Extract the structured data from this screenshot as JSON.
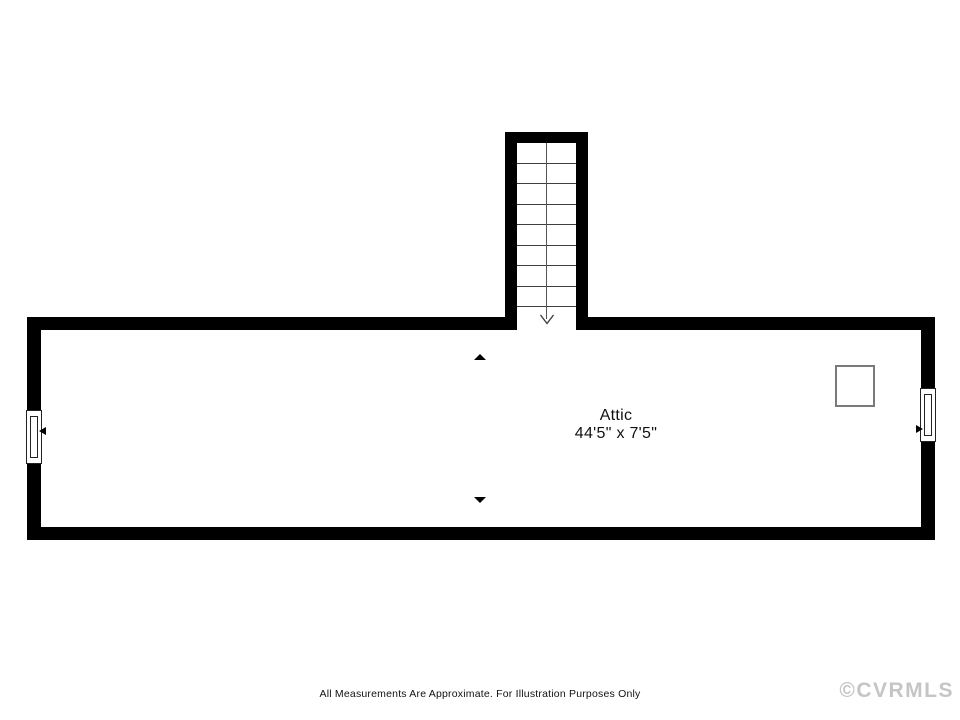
{
  "floor_plan": {
    "room": {
      "name": "Attic",
      "dimensions": "44'5\" x 7'5\""
    },
    "stairs": {
      "tread_count": 9,
      "direction": "down",
      "arrow_icon": "open-v-down-arrow"
    },
    "features": {
      "chimney": "square-outline",
      "left_window": "double-hung-window",
      "right_window": "double-hung-window",
      "section_markers": [
        "triangle-up",
        "triangle-down"
      ]
    },
    "colors": {
      "wall": "#000000",
      "tread_line": "#3f3f3f",
      "chimney_border": "#7a7a7a",
      "watermark": "#c5c5c5",
      "background": "#ffffff"
    },
    "footer": {
      "disclaimer": "All Measurements Are Approximate. For Illustration Purposes Only",
      "watermark": "©CVRMLS"
    }
  }
}
